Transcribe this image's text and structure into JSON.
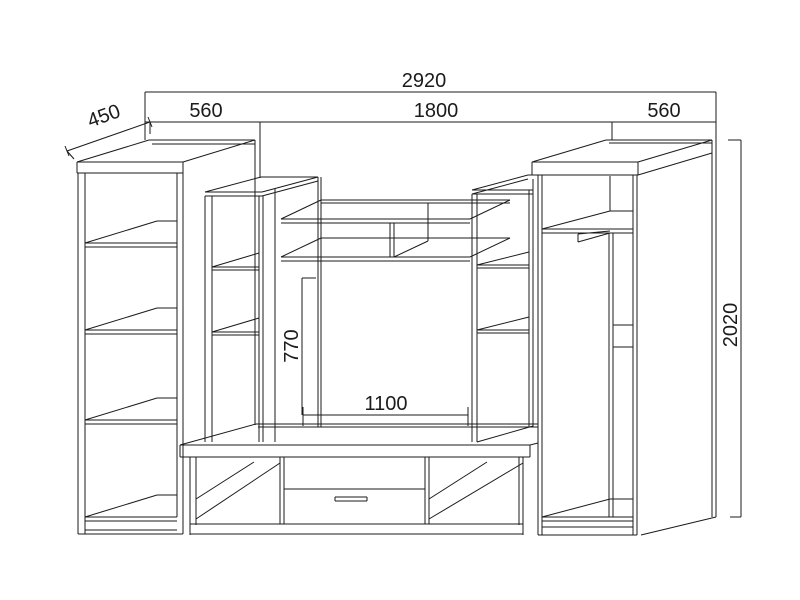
{
  "drawing": {
    "type": "furniture-technical-drawing",
    "subject": "wall unit entertainment center line drawing",
    "background_color": "#ffffff",
    "line_color": "#1b1b1b",
    "units_shown": [
      "left-bookcase",
      "left-mid-cabinet",
      "niche-shelves",
      "right-mid-cabinet",
      "wardrobe",
      "tv-stand"
    ]
  },
  "dim_labels": {
    "total_width": "2920",
    "left_width": "560",
    "center_width": "1800",
    "right_width": "560",
    "depth": "450",
    "niche_height": "770",
    "niche_width": "1100",
    "total_height": "2020"
  }
}
